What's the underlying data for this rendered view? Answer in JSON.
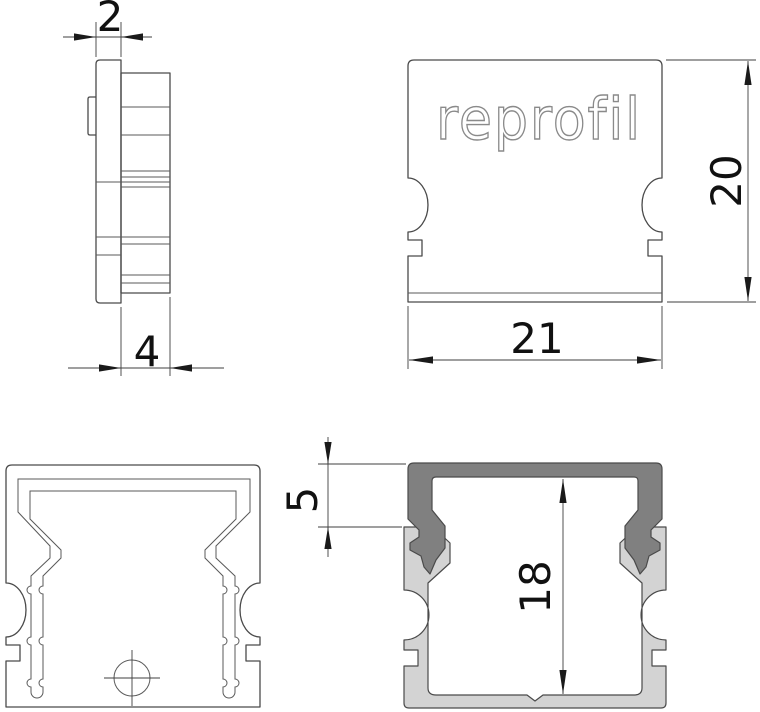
{
  "drawing": {
    "logo_text": "reprofil",
    "dimensions": {
      "cap_face_thickness": "2",
      "cap_total_depth": "4",
      "cap_height": "20",
      "cap_width": "21",
      "collar_depth": "5",
      "inner_height": "18"
    },
    "colors": {
      "line": "#4a4a4a",
      "dimension": "#111111",
      "logo_stroke": "#8a8a8a",
      "cap_section_fill": "#808080",
      "profile_section_fill": "#d3d3d3",
      "background": "#ffffff"
    }
  }
}
